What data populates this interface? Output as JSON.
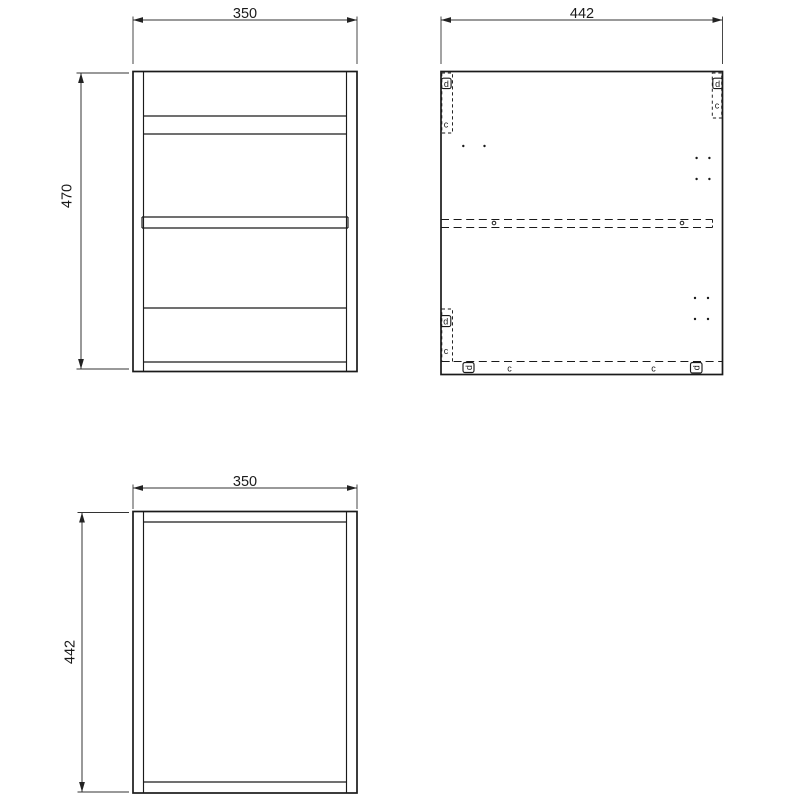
{
  "drawing": {
    "colors": {
      "background": "#ffffff",
      "line": "#1a1a1a",
      "dimension": "#333333"
    },
    "views": {
      "front": {
        "width": "350",
        "height": "470"
      },
      "side": {
        "width": "442"
      },
      "top": {
        "width": "350",
        "depth": "442"
      }
    },
    "fittings": {
      "cam_label": "d",
      "dowel_label": "c"
    }
  }
}
